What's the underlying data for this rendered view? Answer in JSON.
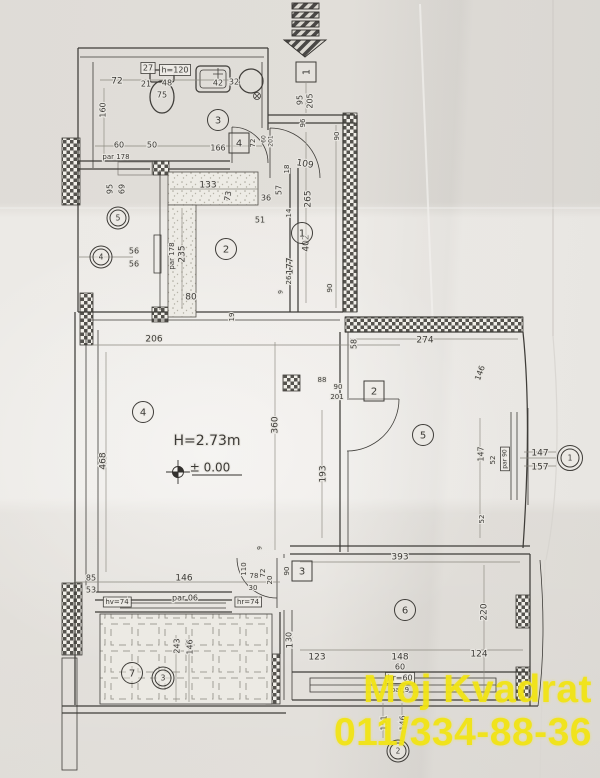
{
  "watermark": {
    "line1": "Moj Kvadrat",
    "line2": "011/334-88-36",
    "color": "#f2e414"
  },
  "plan": {
    "height_label": "H=2.73m",
    "level_label": "± 0.00"
  },
  "tags": [
    {
      "kind": "door",
      "n": "1",
      "x": 306,
      "y": 72,
      "rot": true
    },
    {
      "kind": "door",
      "n": "4",
      "x": 239,
      "y": 143
    },
    {
      "kind": "door",
      "n": "2",
      "x": 374,
      "y": 391
    },
    {
      "kind": "door",
      "n": "3",
      "x": 302,
      "y": 571
    },
    {
      "kind": "room",
      "n": "3",
      "x": 218,
      "y": 120
    },
    {
      "kind": "room",
      "n": "1",
      "x": 302,
      "y": 233
    },
    {
      "kind": "room",
      "n": "2",
      "x": 226,
      "y": 249
    },
    {
      "kind": "room",
      "n": "4",
      "x": 143,
      "y": 412
    },
    {
      "kind": "room",
      "n": "5",
      "x": 423,
      "y": 435
    },
    {
      "kind": "room",
      "n": "6",
      "x": 405,
      "y": 610
    },
    {
      "kind": "room",
      "n": "7",
      "x": 132,
      "y": 673
    },
    {
      "kind": "riser",
      "n": "5",
      "x": 118,
      "y": 218
    },
    {
      "kind": "riser",
      "n": "4",
      "x": 101,
      "y": 257
    },
    {
      "kind": "riser",
      "n": "3",
      "x": 163,
      "y": 678
    },
    {
      "kind": "riser",
      "n": "2",
      "x": 398,
      "y": 751
    },
    {
      "kind": "window",
      "n": "1",
      "x": 570,
      "y": 458
    }
  ],
  "dimensions": [
    {
      "t": "95",
      "x": 300,
      "y": 100,
      "r": -90,
      "s": 8
    },
    {
      "t": "205",
      "x": 310,
      "y": 101,
      "r": -90,
      "s": 8
    },
    {
      "t": "96",
      "x": 303,
      "y": 123,
      "r": -90,
      "s": 7
    },
    {
      "t": "90",
      "x": 337,
      "y": 136,
      "r": -90,
      "s": 7
    },
    {
      "t": "72",
      "x": 117,
      "y": 81,
      "s": 9
    },
    {
      "t": "27",
      "x": 148,
      "y": 68,
      "s": 8,
      "box": true
    },
    {
      "t": "h=120",
      "x": 175,
      "y": 70,
      "s": 8,
      "box": true
    },
    {
      "t": "21",
      "x": 146,
      "y": 84,
      "s": 8
    },
    {
      "t": "48",
      "x": 167,
      "y": 83,
      "s": 8
    },
    {
      "t": "75",
      "x": 162,
      "y": 95,
      "s": 8
    },
    {
      "t": "42",
      "x": 218,
      "y": 83,
      "s": 8
    },
    {
      "t": "32",
      "x": 234,
      "y": 82,
      "s": 8
    },
    {
      "t": "160",
      "x": 103,
      "y": 110,
      "r": -90,
      "s": 8
    },
    {
      "t": "60",
      "x": 119,
      "y": 145,
      "s": 8
    },
    {
      "t": "50",
      "x": 152,
      "y": 145,
      "s": 8
    },
    {
      "t": "166",
      "x": 218,
      "y": 148,
      "s": 8
    },
    {
      "t": "par 178",
      "x": 116,
      "y": 157,
      "s": 7
    },
    {
      "t": "72",
      "x": 253,
      "y": 143,
      "r": -90,
      "s": 7
    },
    {
      "t": "60",
      "x": 264,
      "y": 139,
      "r": -90,
      "s": 6
    },
    {
      "t": "201",
      "x": 271,
      "y": 141,
      "r": -90,
      "s": 6
    },
    {
      "t": "95",
      "x": 110,
      "y": 189,
      "r": -90,
      "s": 8
    },
    {
      "t": "69",
      "x": 122,
      "y": 189,
      "r": -90,
      "s": 8
    },
    {
      "t": "56",
      "x": 134,
      "y": 251,
      "s": 8
    },
    {
      "t": "56",
      "x": 134,
      "y": 264,
      "s": 8
    },
    {
      "t": "109",
      "x": 305,
      "y": 164,
      "r": 10,
      "s": 9
    },
    {
      "t": "18",
      "x": 287,
      "y": 169,
      "r": -90,
      "s": 7
    },
    {
      "t": "36",
      "x": 266,
      "y": 198,
      "s": 8
    },
    {
      "t": "57",
      "x": 279,
      "y": 190,
      "r": -90,
      "s": 8
    },
    {
      "t": "14",
      "x": 289,
      "y": 213,
      "r": -90,
      "s": 7
    },
    {
      "t": "265",
      "x": 308,
      "y": 199,
      "r": -90,
      "s": 9
    },
    {
      "t": "51",
      "x": 260,
      "y": 220,
      "s": 8
    },
    {
      "t": "402",
      "x": 306,
      "y": 243,
      "r": -90,
      "s": 9
    },
    {
      "t": "26",
      "x": 289,
      "y": 280,
      "r": -90,
      "s": 7
    },
    {
      "t": "9",
      "x": 281,
      "y": 292,
      "r": -90,
      "s": 6
    },
    {
      "t": "90",
      "x": 330,
      "y": 288,
      "r": -90,
      "s": 7
    },
    {
      "t": "133",
      "x": 208,
      "y": 185,
      "s": 9
    },
    {
      "t": "73",
      "x": 228,
      "y": 196,
      "r": -80,
      "s": 8
    },
    {
      "t": "235",
      "x": 182,
      "y": 254,
      "r": -90,
      "s": 9
    },
    {
      "t": "par 178",
      "x": 172,
      "y": 256,
      "r": -90,
      "s": 7
    },
    {
      "t": "80",
      "x": 191,
      "y": 297,
      "s": 9
    },
    {
      "t": "177",
      "x": 290,
      "y": 266,
      "r": -90,
      "s": 9
    },
    {
      "t": "19",
      "x": 232,
      "y": 317,
      "r": -90,
      "s": 7
    },
    {
      "t": "88",
      "x": 322,
      "y": 380,
      "s": 7
    },
    {
      "t": "90",
      "x": 338,
      "y": 387,
      "s": 7
    },
    {
      "t": "201",
      "x": 337,
      "y": 397,
      "s": 7
    },
    {
      "t": "206",
      "x": 154,
      "y": 339,
      "s": 9
    },
    {
      "t": "468",
      "x": 103,
      "y": 461,
      "r": -90,
      "s": 9
    },
    {
      "t": "H=2.73m",
      "x": 207,
      "y": 441,
      "s": 14
    },
    {
      "t": "± 0.00",
      "x": 210,
      "y": 468,
      "s": 12
    },
    {
      "t": "360",
      "x": 275,
      "y": 425,
      "r": -90,
      "s": 9
    },
    {
      "t": "193",
      "x": 323,
      "y": 474,
      "r": -90,
      "s": 9
    },
    {
      "t": "58",
      "x": 354,
      "y": 344,
      "r": -90,
      "s": 8
    },
    {
      "t": "274",
      "x": 425,
      "y": 340,
      "s": 9
    },
    {
      "t": "146",
      "x": 480,
      "y": 373,
      "r": -70,
      "s": 8
    },
    {
      "t": "147",
      "x": 481,
      "y": 454,
      "r": -90,
      "s": 8
    },
    {
      "t": "52",
      "x": 493,
      "y": 460,
      "r": -90,
      "s": 7
    },
    {
      "t": "par 90",
      "x": 505,
      "y": 459,
      "r": -90,
      "s": 6,
      "box": true
    },
    {
      "t": "147",
      "x": 540,
      "y": 453,
      "s": 9
    },
    {
      "t": "157",
      "x": 540,
      "y": 467,
      "s": 9
    },
    {
      "t": "52",
      "x": 482,
      "y": 519,
      "r": -90,
      "s": 7
    },
    {
      "t": "393",
      "x": 400,
      "y": 557,
      "s": 9
    },
    {
      "t": "220",
      "x": 484,
      "y": 612,
      "r": -90,
      "s": 9
    },
    {
      "t": "130",
      "x": 290,
      "y": 640,
      "r": -90,
      "s": 9
    },
    {
      "t": "123",
      "x": 317,
      "y": 657,
      "s": 9
    },
    {
      "t": "148",
      "x": 400,
      "y": 657,
      "s": 9
    },
    {
      "t": "124",
      "x": 479,
      "y": 654,
      "s": 9
    },
    {
      "t": "60",
      "x": 400,
      "y": 667,
      "s": 8
    },
    {
      "t": "hr=60",
      "x": 400,
      "y": 678,
      "s": 8,
      "box": true
    },
    {
      "t": "par 9",
      "x": 400,
      "y": 690,
      "s": 7
    },
    {
      "t": "151",
      "x": 384,
      "y": 723,
      "r": -90,
      "s": 8
    },
    {
      "t": "146",
      "x": 403,
      "y": 723,
      "r": -90,
      "s": 8
    },
    {
      "t": "85",
      "x": 91,
      "y": 578,
      "s": 8
    },
    {
      "t": "53",
      "x": 91,
      "y": 590,
      "s": 8
    },
    {
      "t": "146",
      "x": 184,
      "y": 578,
      "s": 9
    },
    {
      "t": "par 06",
      "x": 185,
      "y": 598,
      "s": 8
    },
    {
      "t": "hv=74",
      "x": 117,
      "y": 602,
      "s": 7,
      "box": true
    },
    {
      "t": "hr=74",
      "x": 248,
      "y": 602,
      "s": 7,
      "box": true
    },
    {
      "t": "110",
      "x": 244,
      "y": 569,
      "r": -90,
      "s": 7
    },
    {
      "t": "78",
      "x": 254,
      "y": 576,
      "s": 7
    },
    {
      "t": "30",
      "x": 253,
      "y": 588,
      "s": 7
    },
    {
      "t": "72",
      "x": 263,
      "y": 573,
      "r": -90,
      "s": 7
    },
    {
      "t": "20",
      "x": 270,
      "y": 580,
      "r": -90,
      "s": 7
    },
    {
      "t": "9",
      "x": 260,
      "y": 548,
      "r": -90,
      "s": 6
    },
    {
      "t": "90",
      "x": 287,
      "y": 571,
      "r": -90,
      "s": 7
    },
    {
      "t": "30",
      "x": 289,
      "y": 637,
      "r": -90,
      "s": 8
    },
    {
      "t": "243",
      "x": 177,
      "y": 646,
      "r": -90,
      "s": 8
    },
    {
      "t": "146",
      "x": 190,
      "y": 647,
      "r": -90,
      "s": 8
    }
  ]
}
